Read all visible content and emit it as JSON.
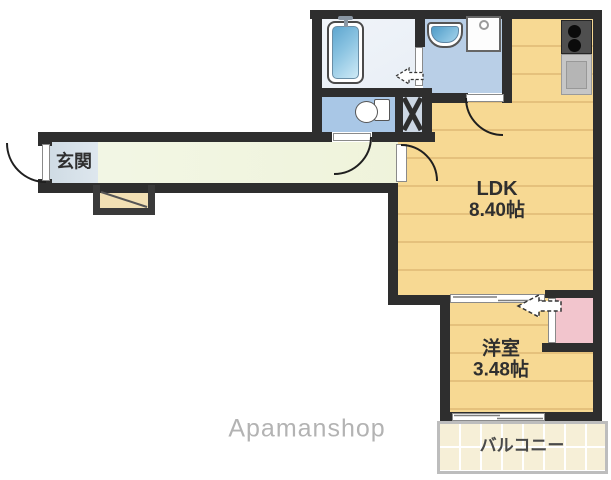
{
  "floorplan": {
    "rooms": {
      "entrance": {
        "label": "玄関"
      },
      "ldk": {
        "name": "LDK",
        "size": "8.40帖"
      },
      "western_room": {
        "name": "洋室",
        "size": "3.48帖"
      },
      "balcony": {
        "name": "バルコニー"
      }
    },
    "fixtures": [
      "bathtub",
      "bath-faucet",
      "wash-basin",
      "washing-machine-pan",
      "toilet",
      "pipe-shaft-x",
      "kitchen-stove",
      "kitchen-counter",
      "closet",
      "entry-step",
      "entrance-door",
      "toilet-door",
      "ldk-door",
      "washroom-door",
      "bath-folding-door",
      "sliding-door",
      "balcony-window"
    ],
    "watermark": "Apamanshop",
    "colors": {
      "wall": "#2e2e2e",
      "floor": "#f7d993",
      "floor_line": "#e5c17c",
      "corridor": "#eff3db",
      "entrance_tile": "#d5dfe7",
      "bathroom": "#e9eff6",
      "washroom": "#b9cfe7",
      "toilet_room": "#a9c7e6",
      "shaft": "#ccd7e4",
      "closet": "#f2c5cd",
      "balcony": "#f6efd7",
      "step": "#f2e0b4",
      "watermark_text": "#b3b3b3"
    }
  }
}
